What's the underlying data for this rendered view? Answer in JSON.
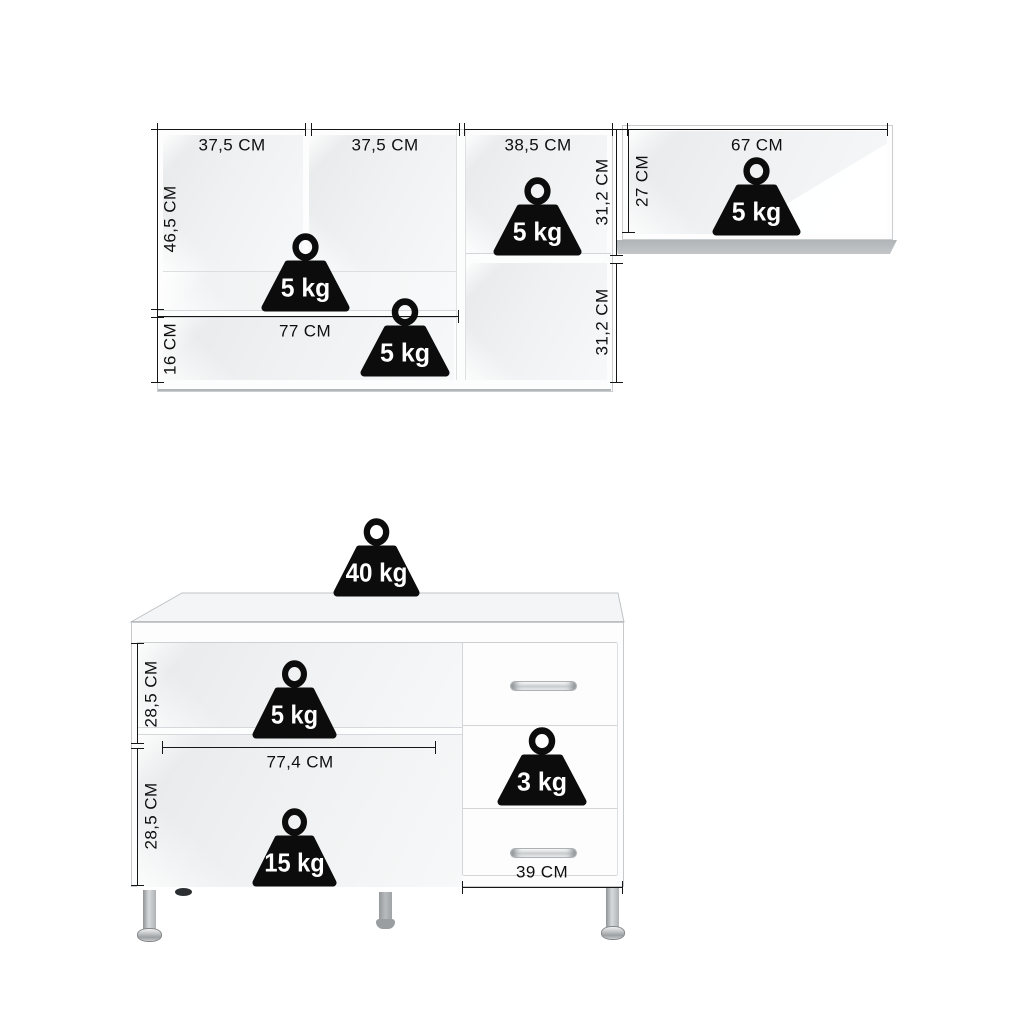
{
  "figure": {
    "kind": "furniture-dimension-diagram",
    "background": "#ffffff",
    "ink": "#161616",
    "weight_fill": "#0c0c0c",
    "weight_text": "#ffffff",
    "interior_gray": "#eef0f1",
    "underside_gray": "#b7bbbd",
    "chrome": "#c6c9cc"
  },
  "wall_cabinet": {
    "width_left": "37,5 CM",
    "width_middle": "37,5 CM",
    "width_right": "38,5 CM",
    "height_upper": "46,5 CM",
    "height_lower": "16 CM",
    "shelf_width": "77 CM",
    "right_height_top": "31,2 CM",
    "right_height_bottom": "31,2 CM",
    "weight_upper": "5 kg",
    "weight_lower": "5 kg",
    "weight_right": "5 kg"
  },
  "wall_shelf": {
    "width": "67 CM",
    "height": "27 CM",
    "weight": "5 kg"
  },
  "base_cabinet": {
    "weight_top": "40 kg",
    "weight_shelf": "5 kg",
    "weight_bottom": "15 kg",
    "weight_drawer": "3 kg",
    "height_upper": "28,5 CM",
    "height_lower": "28,5 CM",
    "inner_width": "77,4 CM",
    "drawer_width": "39 CM"
  }
}
